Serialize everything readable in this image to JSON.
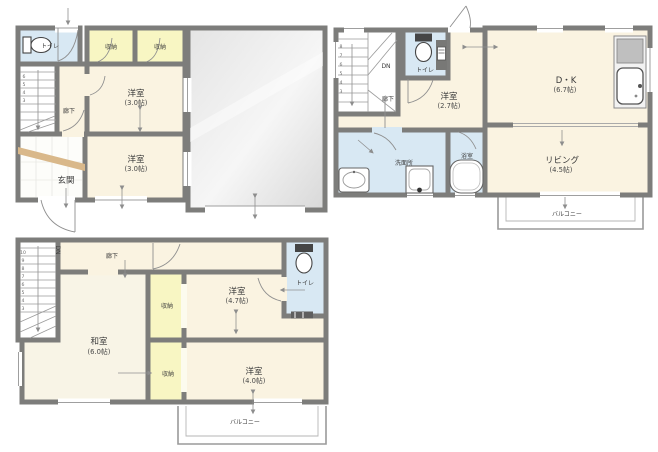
{
  "document": "japanese-residential-floor-plan",
  "colors": {
    "wall": "#7d7d7b",
    "room_floor": "#faf3e1",
    "closet_floor": "#f8f6c3",
    "wet_area_floor": "#d8e8f3",
    "tatami_floor": "#f8f4e6",
    "garage_floor": "#e7e7e7",
    "entrance_step_wood": "#d9b88a",
    "balcony_line": "#9a9a9a",
    "text": "#3b3b3b"
  },
  "plans": {
    "p1": {
      "toilet": "トイレ",
      "closet_a": "収納",
      "closet_b": "収納",
      "bedroom_a": "洋室",
      "bedroom_a_size": "(3.0帖)",
      "hallway": "廊下",
      "entrance": "玄関",
      "bedroom_b": "洋室",
      "bedroom_b_size": "(3.0帖)",
      "stairs_numbers": [
        "6",
        "5",
        "4",
        "3"
      ]
    },
    "p2": {
      "dn": "DN",
      "hallway": "廊下",
      "toilet": "トイレ",
      "bedroom": "洋室",
      "bedroom_size": "(2.7帖)",
      "dk": "D・K",
      "dk_size": "(6.7帖)",
      "living": "リビング",
      "living_size": "(4.5帖)",
      "washroom": "洗面所",
      "bath": "浴室",
      "balcony": "バルコニー",
      "stairs_numbers": [
        "8",
        "7",
        "6",
        "5",
        "4",
        "3"
      ]
    },
    "p3": {
      "dn": "DN",
      "hallway": "廊下",
      "tatami_room": "和室",
      "tatami_room_size": "(6.0帖)",
      "closet_a": "収納",
      "bedroom_a": "洋室",
      "bedroom_a_size": "(4.7帖)",
      "toilet": "トイレ",
      "closet_b": "収納",
      "bedroom_b": "洋室",
      "bedroom_b_size": "(4.0帖)",
      "balcony": "バルコニー",
      "stairs_numbers": [
        "10",
        "9",
        "8",
        "7",
        "6",
        "5",
        "4",
        "3"
      ]
    }
  }
}
